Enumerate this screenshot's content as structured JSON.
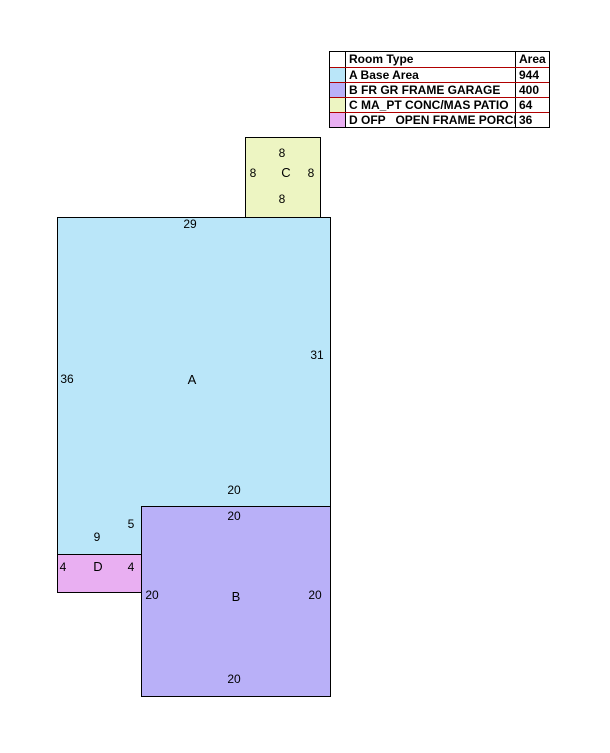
{
  "colors": {
    "base_area": "#BAE6F9",
    "garage": "#B9B0F8",
    "patio": "#EDF5C2",
    "porch": "#E9AFF2",
    "outline": "#000000",
    "table_line": "#B00000"
  },
  "legend": {
    "header": {
      "room_type": "Room Type",
      "area": "Area"
    },
    "rows": [
      {
        "room_type": "A Base Area",
        "area": "944",
        "color": "#BAE6F9"
      },
      {
        "room_type": "B FR GR FRAME GARAGE",
        "area": "400",
        "color": "#B9B0F8"
      },
      {
        "room_type": "C MA_PT CONC/MAS PATIO",
        "area": "64",
        "color": "#EDF5C2"
      },
      {
        "room_type": "D OFP   OPEN FRAME PORCH",
        "area": "36",
        "color": "#E9AFF2"
      }
    ]
  },
  "sketch": {
    "areas": {
      "patio": {
        "label": "C",
        "dims": {
          "top": "8",
          "left": "8",
          "right": "8",
          "bottom": "8"
        }
      },
      "base": {
        "label": "A",
        "dims": {
          "top": "29",
          "left": "36",
          "right": "31",
          "bottom_right": "20",
          "step": "5",
          "bottom_left": "9"
        }
      },
      "garage": {
        "label": "B",
        "dims": {
          "top": "20",
          "left": "20",
          "right": "20",
          "bottom": "20"
        }
      },
      "porch": {
        "label": "D",
        "dims": {
          "left": "4",
          "right": "4"
        }
      }
    }
  }
}
